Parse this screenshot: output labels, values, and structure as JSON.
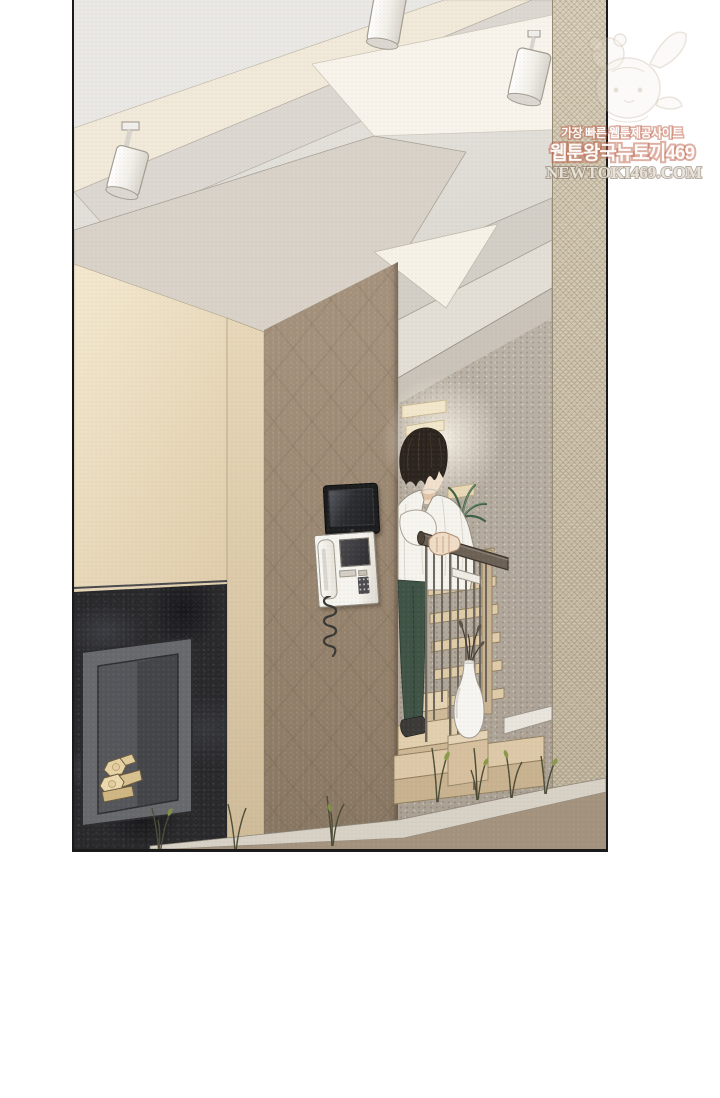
{
  "watermark": {
    "tagline": "가장 빠른 웹툰제공사이트",
    "site_name": "웹툰왕국뉴토끼469",
    "site_url": "NEWTOKI469.COM",
    "outline_color": "#be624a",
    "url_color": "#8a8072"
  },
  "scene": {
    "type": "webtoon-panel",
    "setting": "modern house interior: living room with fireplace and a staircase hallway",
    "objects": [
      "ceiling-track-spotlights",
      "angled-ceiling-beams",
      "black-granite-fireplace-with-firewood",
      "wall-mounted-monitor",
      "white-intercom-phone-with-coiled-cord",
      "man-with-dark-hair-white-shirt-green-pants-at-stair-railing",
      "wooden-stair-treads-with-thin-metal-balusters",
      "white-bottle-vase-with-dry-branches",
      "palm-plant",
      "white-dome-vessel",
      "woven-stone-column",
      "small-floor-sprouts"
    ]
  },
  "palette": {
    "panel_border": "#1a1a1a",
    "ceiling_cream": "#f1e9d9",
    "ceiling_gray": "#dcd7d1",
    "cream_wall": "#ecdcbf",
    "brown_wall": "#a3907b",
    "granite_fireplace": "#28282b",
    "hallway_wall": "#bbb2a6",
    "stone_column": "#ccc1ab",
    "wood_tread": "#e0cba8",
    "shirt_white": "#f5f3ee",
    "pants_green": "#3e5345",
    "plant_green": "#3f6044"
  }
}
